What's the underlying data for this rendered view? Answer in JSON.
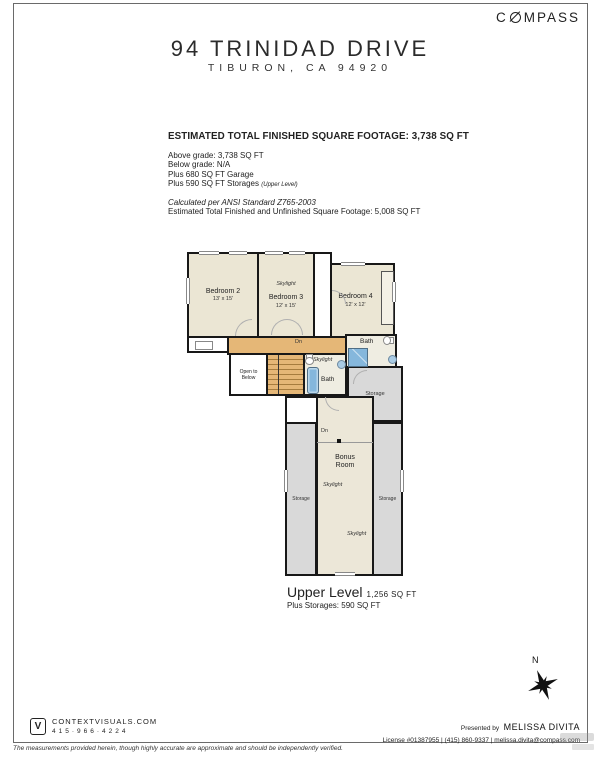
{
  "brand": {
    "logo_pre": "C",
    "logo_post": "MPASS"
  },
  "header": {
    "title": "94 TRINIDAD DRIVE",
    "subtitle": "TIBURON, CA 94920"
  },
  "summary": {
    "heading": "ESTIMATED TOTAL FINISHED SQUARE FOOTAGE: 3,738 SQ FT",
    "above_grade": "Above grade: 3,738 SQ FT",
    "below_grade": "Below grade: N/A",
    "garage": "Plus 680 SQ FT Garage",
    "storages": "Plus 590 SQ FT Storages",
    "storages_note": "(Upper Level)",
    "ansi": "Calculated per ANSI Standard Z765-2003",
    "total": "Estimated Total Finished and Unfinished Square Footage: 5,008 SQ FT"
  },
  "plan": {
    "rooms": {
      "bedroom2": {
        "name": "Bedroom 2",
        "dims": "13' x 15'"
      },
      "bedroom3": {
        "name": "Bedroom 3",
        "dims": "12' x 15'"
      },
      "bedroom4": {
        "name": "Bedroom 4",
        "dims": "12' x 12'"
      },
      "bonus": {
        "name": "Bonus Room"
      },
      "open_to_below": "Open to Below"
    },
    "labels": {
      "skylight": "Skylight",
      "dn": "Dn",
      "bath": "Bath",
      "storage": "Storage"
    }
  },
  "level": {
    "name": "Upper Level",
    "area": "1,256 SQ FT",
    "plus": "Plus Storages: 590 SQ FT"
  },
  "compass_rose": {
    "north": "N"
  },
  "footer": {
    "left": {
      "logo_letter": "V",
      "site": "CONTEXTVISUALS.COM",
      "phone": "415·966·4224"
    },
    "right": {
      "presented_by": "Presented by",
      "agent": "MELISSA DIVITA",
      "contact": "License #01387955 | (415) 860-9337 | melissa.divita@compass.com"
    }
  },
  "disclaimer": "The measurements provided herein, though highly accurate are approximate and should be independently verified.",
  "colors": {
    "hall": "#E5B777",
    "room_fill": "#EBE6D4",
    "storage_fill": "#D9D9D9",
    "bath_fill": "#EFEDE2",
    "fixture_blue": "#85B7DC",
    "wall": "#181818"
  }
}
